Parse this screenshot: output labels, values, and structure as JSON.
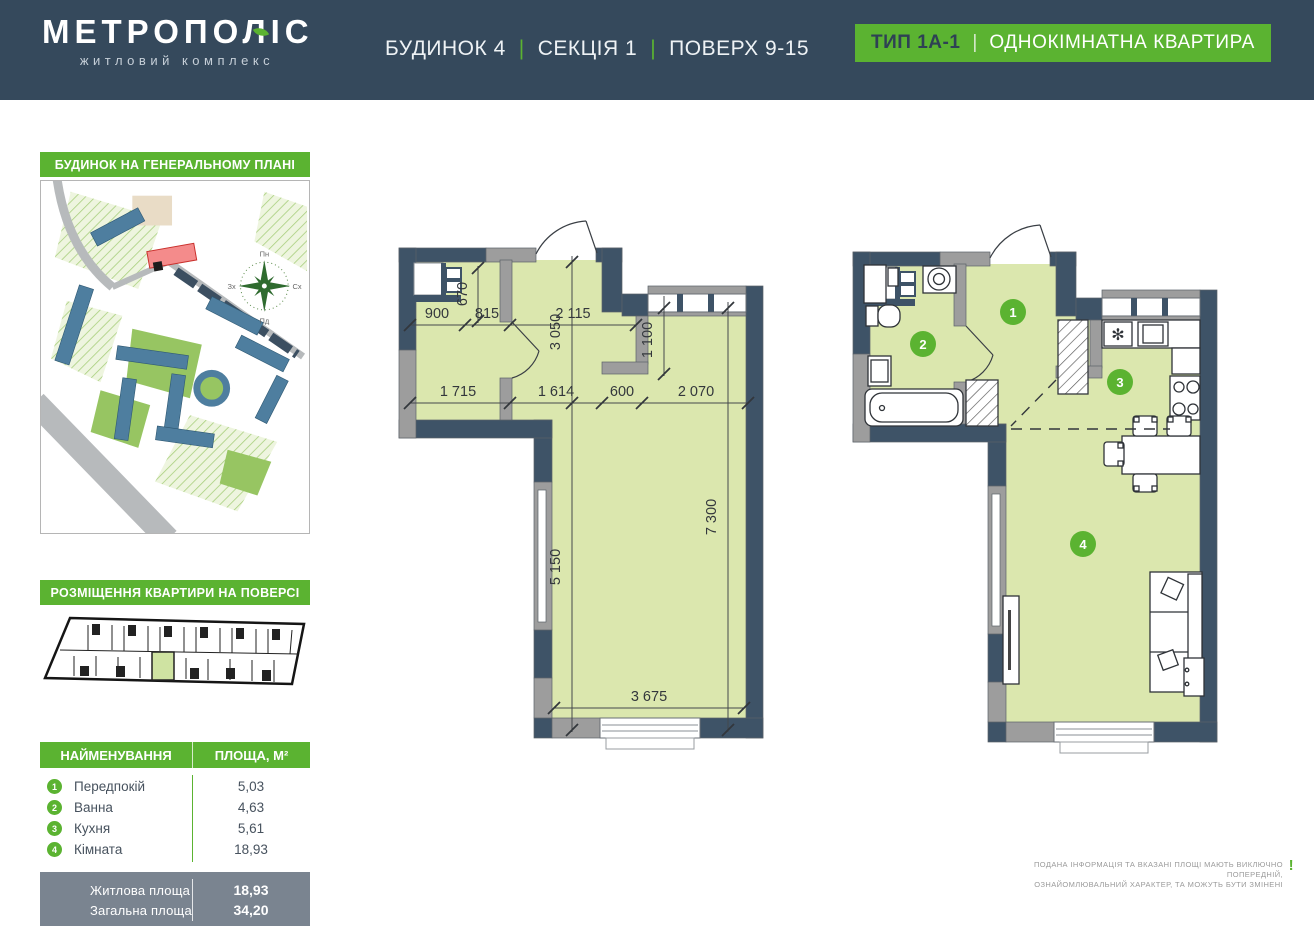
{
  "header": {
    "logo_title": "МЕТРОПОЛІС",
    "logo_subtitle": "житловий комплекс",
    "building": "БУДИНОК 4",
    "section": "СЕКЦІЯ 1",
    "floors": "ПОВЕРХ 9-15",
    "separator": "|",
    "badge_type": "ТИП 1А-1",
    "badge_name": "ОДНОКІМНАТНА КВАРТИРА"
  },
  "sidebar": {
    "general_plan_label": "БУДИНОК НА ГЕНЕРАЛЬНОМУ ПЛАНІ",
    "floor_plan_label": "РОЗМІЩЕННЯ КВАРТИРИ НА ПОВЕРСІ",
    "compass": {
      "n": "Пн",
      "e": "Сх",
      "s": "Пд",
      "w": "Зх"
    },
    "table": {
      "col_name": "НАЙМЕНУВАННЯ",
      "col_area": "ПЛОЩА, М²",
      "rows": [
        {
          "num": "1",
          "name": "Передпокій",
          "area": "5,03"
        },
        {
          "num": "2",
          "name": "Ванна",
          "area": "4,63"
        },
        {
          "num": "3",
          "name": "Кухня",
          "area": "5,61"
        },
        {
          "num": "4",
          "name": "Кімната",
          "area": "18,93"
        }
      ],
      "totals": [
        {
          "label": "Житлова площа",
          "value": "18,93"
        },
        {
          "label": "Загальна площа",
          "value": "34,20"
        }
      ]
    }
  },
  "plans": {
    "dims": {
      "d670": "670",
      "d900": "900",
      "d815": "815",
      "d2115": "2 115",
      "d3050": "3 050",
      "d1100": "1 100",
      "d1715": "1 715",
      "d1614": "1 614",
      "d600": "600",
      "d2070": "2 070",
      "d5150": "5 150",
      "d7300": "7 300",
      "d3675": "3 675"
    },
    "rooms": [
      "1",
      "2",
      "3",
      "4"
    ]
  },
  "footer": {
    "disclaimer_line1": "ПОДАНА ІНФОРМАЦІЯ ТА ВКАЗАНІ ПЛОЩІ МАЮТЬ ВИКЛЮЧНО ПОПЕРЕДНІЙ,",
    "disclaimer_line2": "ОЗНАЙОМЛЮВАЛЬНИЙ ХАРАКТЕР, ТА МОЖУТЬ БУТИ ЗМІНЕНІ",
    "mark": "!"
  },
  "colors": {
    "header_bg": "#35495c",
    "accent_green": "#5bb331",
    "plan_fill": "#dbe7ae",
    "wall_navy": "#3e5367",
    "wall_gray": "#9d9d9d",
    "totals_bg": "#7a8490"
  }
}
